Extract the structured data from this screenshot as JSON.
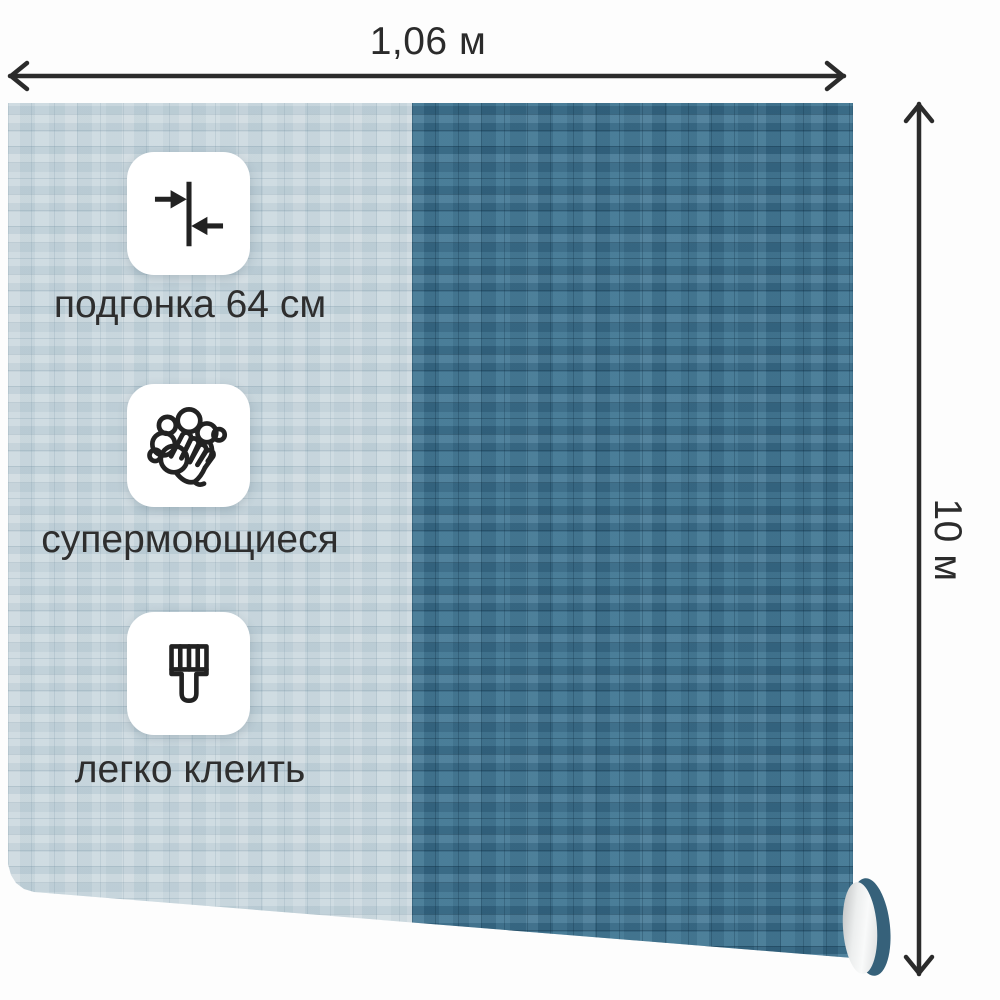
{
  "product": {
    "type": "wallpaper-roll",
    "dimensions": {
      "width_label": "1,06 м",
      "height_label": "10 м"
    },
    "features": [
      {
        "icon": "seam-match-icon",
        "label": "подгонка 64 см"
      },
      {
        "icon": "washable-hands-icon",
        "label": "супермоющиеся"
      },
      {
        "icon": "paint-brush-icon",
        "label": "легко клеить"
      }
    ],
    "colors": {
      "wallpaper_light": "#c5d3da",
      "wallpaper_dark": "#40708c",
      "annotation": "#2b2b2b",
      "badge_background": "#ffffff",
      "roll_inner": "#eceeee"
    }
  }
}
